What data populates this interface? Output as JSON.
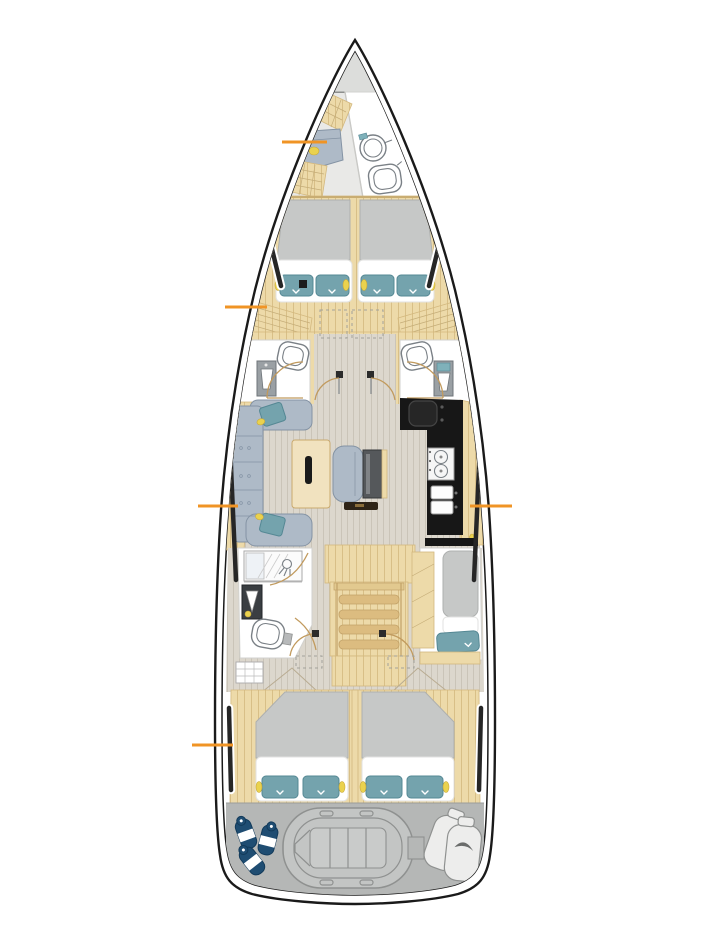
{
  "page": {
    "aria_label": "Sailing yacht interior deck layout plan, top-down view",
    "background": "#ffffff"
  },
  "colors": {
    "page-bg": "#ffffff",
    "hull-line": "#1a1a1a",
    "wood": "#eddaa9",
    "wood-grain": "#d3b87e",
    "wood-step": "#dcbc80",
    "floor": "#dcd7cd",
    "floor-grain": "#c8c2b5",
    "room": "#ffffff",
    "gray-floor": "#e9e9e7",
    "anchor-locker": "#dcdddb",
    "mattress": "#c6c8c7",
    "mattress-edge": "#aeb0af",
    "pillow": "#74a3ad",
    "pillow-edge": "#558894",
    "sofa": "#aebac7",
    "sofa-edge": "#8493a4",
    "galley": "#171717",
    "stern": "#b5b7b6",
    "outline": "#8f9190",
    "fixture": "#7a8086",
    "door": "#c19a5d",
    "fender": "#1f4d72",
    "light-dot": "#ead24e",
    "dark-bench": "#2e2417",
    "accent": "#f09425"
  },
  "legend": {
    "zones": [
      "anchor-locker",
      "forward-head",
      "forward-owner-cabin",
      "port-head",
      "starboard-head",
      "saloon",
      "galley",
      "companionway-stairs",
      "aft-bathroom",
      "starboard-berth",
      "aft-port-cabin",
      "aft-starboard-cabin",
      "tender-garage"
    ]
  },
  "callouts": [
    {
      "name": "callout-forward-seat",
      "points_to": "forward-head-seat"
    },
    {
      "name": "callout-forward-cabin-steps",
      "points_to": "forward-cabin-steps"
    },
    {
      "name": "callout-saloon-sofa",
      "points_to": "saloon-sofa"
    },
    {
      "name": "callout-galley",
      "points_to": "galley-counter"
    },
    {
      "name": "callout-aft-cabin",
      "points_to": "aft-port-cabin"
    }
  ]
}
